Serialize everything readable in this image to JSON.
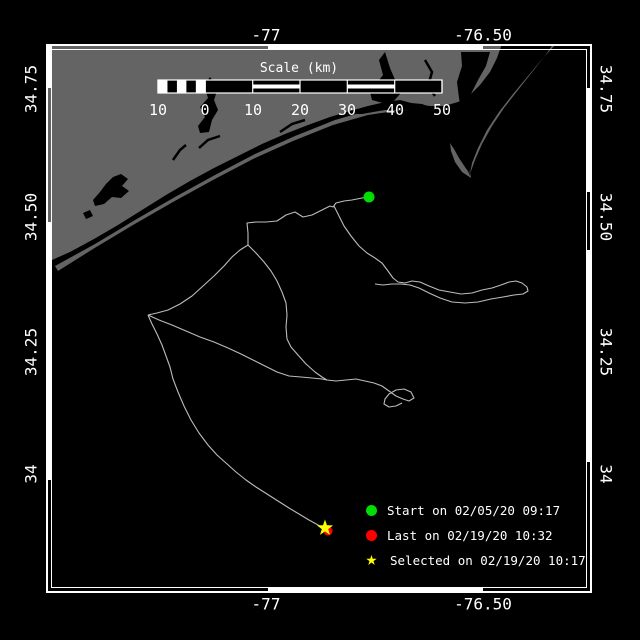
{
  "axes": {
    "top": [
      {
        "label": "-77",
        "x": 266,
        "y": 35
      },
      {
        "label": "-76.50",
        "x": 483,
        "y": 35
      }
    ],
    "bottom": [
      {
        "label": "-77",
        "x": 266,
        "y": 604
      },
      {
        "label": "-76.50",
        "x": 483,
        "y": 604
      }
    ],
    "left": [
      {
        "label": "34.75",
        "x": 31,
        "y": 89
      },
      {
        "label": "34.50",
        "x": 31,
        "y": 217
      },
      {
        "label": "34.25",
        "x": 31,
        "y": 352
      },
      {
        "label": "34",
        "x": 31,
        "y": 474
      }
    ],
    "right": [
      {
        "label": "34.75",
        "x": 606,
        "y": 89
      },
      {
        "label": "34.50",
        "x": 606,
        "y": 217
      },
      {
        "label": "34.25",
        "x": 606,
        "y": 352
      },
      {
        "label": "34",
        "x": 606,
        "y": 474
      }
    ]
  },
  "scalebar": {
    "title": "Scale (km)",
    "title_x": 299,
    "title_y": 61,
    "x": 158,
    "y": 80,
    "w": 284,
    "h": 13,
    "tick_xs": [
      158,
      205.3,
      252.7,
      300,
      347.3,
      394.7,
      442
    ],
    "tick_labels": [
      "10",
      "0",
      "10",
      "20",
      "30",
      "40",
      "50"
    ],
    "label_y": 101,
    "striped_sections": [
      [
        252.7,
        300
      ],
      [
        347.3,
        394.7
      ]
    ],
    "solid_sections": [
      [
        205.3,
        252.7
      ],
      [
        300,
        347.3
      ],
      [
        394.7,
        442
      ]
    ],
    "subcell_range": [
      158,
      205.3
    ],
    "subcells": 5
  },
  "legend": {
    "items": [
      {
        "marker": "circle",
        "color": "#00dd00",
        "label": "Start on 02/05/20 09:17"
      },
      {
        "marker": "circle",
        "color": "#ff0000",
        "label": "Last on 02/19/20 10:32"
      },
      {
        "marker": "star",
        "color": "#ffff00",
        "label": "Selected on 02/19/20 10:17"
      }
    ],
    "star_glyph": "★"
  },
  "markers": {
    "start": {
      "x": 369,
      "y": 197,
      "r": 5.5,
      "color": "#00dd00"
    },
    "last": {
      "x": 328,
      "y": 531,
      "r": 4.5,
      "color": "#ff0000"
    },
    "selected": {
      "x": 325,
      "y": 528,
      "r_outer": 8.5,
      "r_inner": 3.4,
      "color": "#ffff00"
    }
  },
  "map": {
    "frame": {
      "x1": 46,
      "y1": 44,
      "x2": 592,
      "y2": 593,
      "band": 5
    },
    "zebra": [
      {
        "edge": "top",
        "from": 268,
        "to": 483
      },
      {
        "edge": "bottom",
        "from": 268,
        "to": 483
      },
      {
        "edge": "left",
        "from": 44,
        "to": 88
      },
      {
        "edge": "left",
        "from": 222,
        "to": 480
      },
      {
        "edge": "right",
        "from": 88,
        "to": 192
      },
      {
        "edge": "right",
        "from": 250,
        "to": 462
      }
    ],
    "colors": {
      "ocean": "#000000",
      "land": "#646464",
      "track": "#bcbcbc",
      "frame": "#ffffff"
    },
    "land_polygons": [
      [
        [
          46,
          44
        ],
        [
          502,
          44
        ],
        [
          497,
          58
        ],
        [
          490,
          72
        ],
        [
          480,
          85
        ],
        [
          470,
          95
        ],
        [
          458,
          102
        ],
        [
          444,
          106
        ],
        [
          430,
          106
        ],
        [
          415,
          104
        ],
        [
          400,
          100
        ],
        [
          385,
          102
        ],
        [
          368,
          106
        ],
        [
          350,
          111
        ],
        [
          330,
          117
        ],
        [
          308,
          125
        ],
        [
          285,
          134
        ],
        [
          262,
          144
        ],
        [
          238,
          156
        ],
        [
          214,
          168
        ],
        [
          190,
          181
        ],
        [
          166,
          195
        ],
        [
          142,
          210
        ],
        [
          118,
          225
        ],
        [
          94,
          239
        ],
        [
          70,
          252
        ],
        [
          52,
          260
        ],
        [
          46,
          262
        ]
      ],
      [
        [
          55,
          266
        ],
        [
          95,
          244
        ],
        [
          135,
          220
        ],
        [
          175,
          197
        ],
        [
          215,
          175
        ],
        [
          255,
          154
        ],
        [
          295,
          136
        ],
        [
          335,
          120
        ],
        [
          370,
          110
        ],
        [
          398,
          106
        ],
        [
          422,
          108
        ],
        [
          438,
          114
        ],
        [
          450,
          125
        ],
        [
          459,
          139
        ],
        [
          465,
          154
        ],
        [
          469,
          167
        ],
        [
          471,
          178
        ],
        [
          468,
          168
        ],
        [
          463,
          153
        ],
        [
          456,
          138
        ],
        [
          446,
          125
        ],
        [
          433,
          116
        ],
        [
          417,
          111
        ],
        [
          395,
          111
        ],
        [
          368,
          115
        ],
        [
          333,
          125
        ],
        [
          293,
          141
        ],
        [
          253,
          159
        ],
        [
          213,
          180
        ],
        [
          173,
          202
        ],
        [
          133,
          225
        ],
        [
          93,
          249
        ],
        [
          58,
          271
        ]
      ],
      [
        [
          471,
          178
        ],
        [
          462,
          172
        ],
        [
          455,
          162
        ],
        [
          451,
          151
        ],
        [
          450,
          143
        ],
        [
          454,
          149
        ],
        [
          459,
          158
        ],
        [
          465,
          167
        ],
        [
          470,
          174
        ]
      ],
      [
        [
          556,
          44
        ],
        [
          543,
          58
        ],
        [
          528,
          76
        ],
        [
          513,
          94
        ],
        [
          499,
          112
        ],
        [
          487,
          130
        ],
        [
          478,
          148
        ],
        [
          472,
          163
        ],
        [
          470,
          174
        ],
        [
          475,
          160
        ],
        [
          482,
          144
        ],
        [
          492,
          126
        ],
        [
          504,
          108
        ],
        [
          518,
          90
        ],
        [
          533,
          71
        ],
        [
          547,
          53
        ],
        [
          553,
          44
        ]
      ]
    ],
    "water_polygons": [
      [
        [
          93,
          200
        ],
        [
          100,
          192
        ],
        [
          106,
          184
        ],
        [
          113,
          177
        ],
        [
          121,
          174
        ],
        [
          128,
          179
        ],
        [
          122,
          186
        ],
        [
          129,
          191
        ],
        [
          121,
          198
        ],
        [
          112,
          197
        ],
        [
          104,
          204
        ],
        [
          95,
          206
        ]
      ],
      [
        [
          83,
          213
        ],
        [
          90,
          210
        ],
        [
          93,
          216
        ],
        [
          86,
          219
        ]
      ],
      [
        [
          200,
          133
        ],
        [
          209,
          132
        ],
        [
          212,
          120
        ],
        [
          218,
          110
        ],
        [
          214,
          100
        ],
        [
          218,
          88
        ],
        [
          210,
          77
        ],
        [
          204,
          85
        ],
        [
          208,
          98
        ],
        [
          200,
          107
        ],
        [
          205,
          117
        ],
        [
          198,
          126
        ]
      ],
      [
        [
          372,
          100
        ],
        [
          383,
          103
        ],
        [
          393,
          102
        ],
        [
          400,
          94
        ],
        [
          396,
          82
        ],
        [
          390,
          68
        ],
        [
          385,
          52
        ],
        [
          379,
          60
        ],
        [
          383,
          75
        ],
        [
          376,
          84
        ],
        [
          370,
          92
        ]
      ],
      [
        [
          461,
          52
        ],
        [
          490,
          52
        ],
        [
          486,
          66
        ],
        [
          478,
          80
        ],
        [
          471,
          94
        ],
        [
          467,
          107
        ],
        [
          462,
          113
        ],
        [
          459,
          98
        ],
        [
          457,
          82
        ],
        [
          462,
          66
        ]
      ],
      [
        [
          348,
          114
        ],
        [
          375,
          106
        ],
        [
          400,
          102
        ],
        [
          422,
          104
        ],
        [
          438,
          110
        ],
        [
          450,
          120
        ],
        [
          459,
          133
        ],
        [
          465,
          148
        ],
        [
          469,
          164
        ],
        [
          470,
          176
        ],
        [
          466,
          166
        ],
        [
          460,
          150
        ],
        [
          452,
          136
        ],
        [
          441,
          124
        ],
        [
          427,
          116
        ],
        [
          408,
          111
        ],
        [
          385,
          110
        ],
        [
          362,
          114
        ]
      ]
    ],
    "water_lines": [
      [
        [
          173,
          160
        ],
        [
          180,
          150
        ],
        [
          186,
          145
        ]
      ],
      [
        [
          199,
          148
        ],
        [
          208,
          140
        ],
        [
          220,
          136
        ]
      ],
      [
        [
          280,
          132
        ],
        [
          292,
          124
        ],
        [
          305,
          120
        ]
      ],
      [
        [
          425,
          60
        ],
        [
          432,
          72
        ],
        [
          428,
          86
        ],
        [
          435,
          96
        ]
      ]
    ],
    "tracks": [
      [
        [
          369,
          197
        ],
        [
          362,
          198
        ],
        [
          352,
          200
        ],
        [
          344,
          201
        ],
        [
          336,
          203
        ],
        [
          333,
          207
        ],
        [
          330,
          206
        ],
        [
          322,
          210
        ],
        [
          312,
          215
        ],
        [
          303,
          217
        ],
        [
          295,
          212
        ],
        [
          286,
          215
        ],
        [
          277,
          221
        ],
        [
          266,
          222
        ],
        [
          256,
          222
        ],
        [
          247,
          223
        ],
        [
          248,
          233
        ],
        [
          248,
          245
        ]
      ],
      [
        [
          248,
          245
        ],
        [
          240,
          250
        ],
        [
          232,
          257
        ],
        [
          224,
          266
        ],
        [
          214,
          276
        ],
        [
          203,
          286
        ],
        [
          192,
          296
        ],
        [
          180,
          304
        ],
        [
          168,
          310
        ],
        [
          157,
          313
        ],
        [
          148,
          315
        ]
      ],
      [
        [
          248,
          245
        ],
        [
          256,
          253
        ],
        [
          264,
          262
        ],
        [
          271,
          271
        ],
        [
          277,
          281
        ],
        [
          282,
          292
        ],
        [
          286,
          303
        ],
        [
          287,
          315
        ],
        [
          286,
          327
        ],
        [
          287,
          339
        ],
        [
          291,
          347
        ],
        [
          298,
          355
        ],
        [
          306,
          364
        ],
        [
          315,
          372
        ],
        [
          322,
          377
        ],
        [
          327,
          380
        ]
      ],
      [
        [
          334,
          206
        ],
        [
          339,
          216
        ],
        [
          344,
          226
        ],
        [
          351,
          236
        ],
        [
          359,
          246
        ],
        [
          367,
          253
        ],
        [
          375,
          258
        ],
        [
          382,
          263
        ],
        [
          388,
          271
        ],
        [
          393,
          278
        ],
        [
          398,
          282
        ],
        [
          405,
          283
        ],
        [
          412,
          281
        ],
        [
          420,
          282
        ],
        [
          429,
          286
        ],
        [
          439,
          290
        ],
        [
          450,
          292
        ],
        [
          461,
          294
        ],
        [
          472,
          293
        ],
        [
          482,
          290
        ],
        [
          492,
          288
        ],
        [
          501,
          285
        ],
        [
          509,
          282
        ],
        [
          516,
          281
        ],
        [
          522,
          283
        ],
        [
          527,
          287
        ],
        [
          528,
          291
        ],
        [
          523,
          294
        ],
        [
          514,
          295
        ],
        [
          503,
          297
        ],
        [
          491,
          299
        ],
        [
          478,
          302
        ],
        [
          465,
          303
        ],
        [
          452,
          302
        ],
        [
          440,
          298
        ],
        [
          429,
          293
        ],
        [
          419,
          288
        ],
        [
          410,
          285
        ],
        [
          401,
          284
        ],
        [
          392,
          284
        ],
        [
          383,
          285
        ],
        [
          375,
          284
        ]
      ],
      [
        [
          148,
          315
        ],
        [
          159,
          320
        ],
        [
          172,
          325
        ],
        [
          186,
          331
        ],
        [
          200,
          337
        ],
        [
          214,
          342
        ],
        [
          228,
          348
        ],
        [
          241,
          354
        ],
        [
          253,
          360
        ],
        [
          265,
          366
        ],
        [
          277,
          372
        ],
        [
          289,
          376
        ],
        [
          301,
          377
        ],
        [
          312,
          378
        ],
        [
          322,
          379
        ],
        [
          327,
          380
        ],
        [
          336,
          381
        ],
        [
          346,
          380
        ],
        [
          356,
          379
        ],
        [
          365,
          381
        ],
        [
          374,
          383
        ],
        [
          382,
          386
        ],
        [
          389,
          391
        ],
        [
          396,
          396
        ],
        [
          403,
          399
        ],
        [
          409,
          401
        ],
        [
          414,
          398
        ],
        [
          411,
          392
        ],
        [
          404,
          389
        ],
        [
          396,
          390
        ],
        [
          389,
          394
        ],
        [
          385,
          399
        ],
        [
          384,
          404
        ],
        [
          389,
          407
        ],
        [
          396,
          406
        ],
        [
          402,
          403
        ]
      ],
      [
        [
          148,
          315
        ],
        [
          152,
          324
        ],
        [
          157,
          334
        ],
        [
          162,
          345
        ],
        [
          166,
          356
        ],
        [
          170,
          367
        ],
        [
          173,
          379
        ],
        [
          178,
          392
        ],
        [
          184,
          406
        ],
        [
          191,
          420
        ],
        [
          199,
          433
        ],
        [
          208,
          445
        ],
        [
          217,
          455
        ],
        [
          226,
          463
        ],
        [
          236,
          472
        ],
        [
          246,
          480
        ],
        [
          256,
          487
        ],
        [
          267,
          494
        ],
        [
          278,
          501
        ],
        [
          289,
          508
        ],
        [
          299,
          514
        ],
        [
          309,
          520
        ],
        [
          318,
          525
        ],
        [
          325,
          529
        ]
      ]
    ]
  }
}
